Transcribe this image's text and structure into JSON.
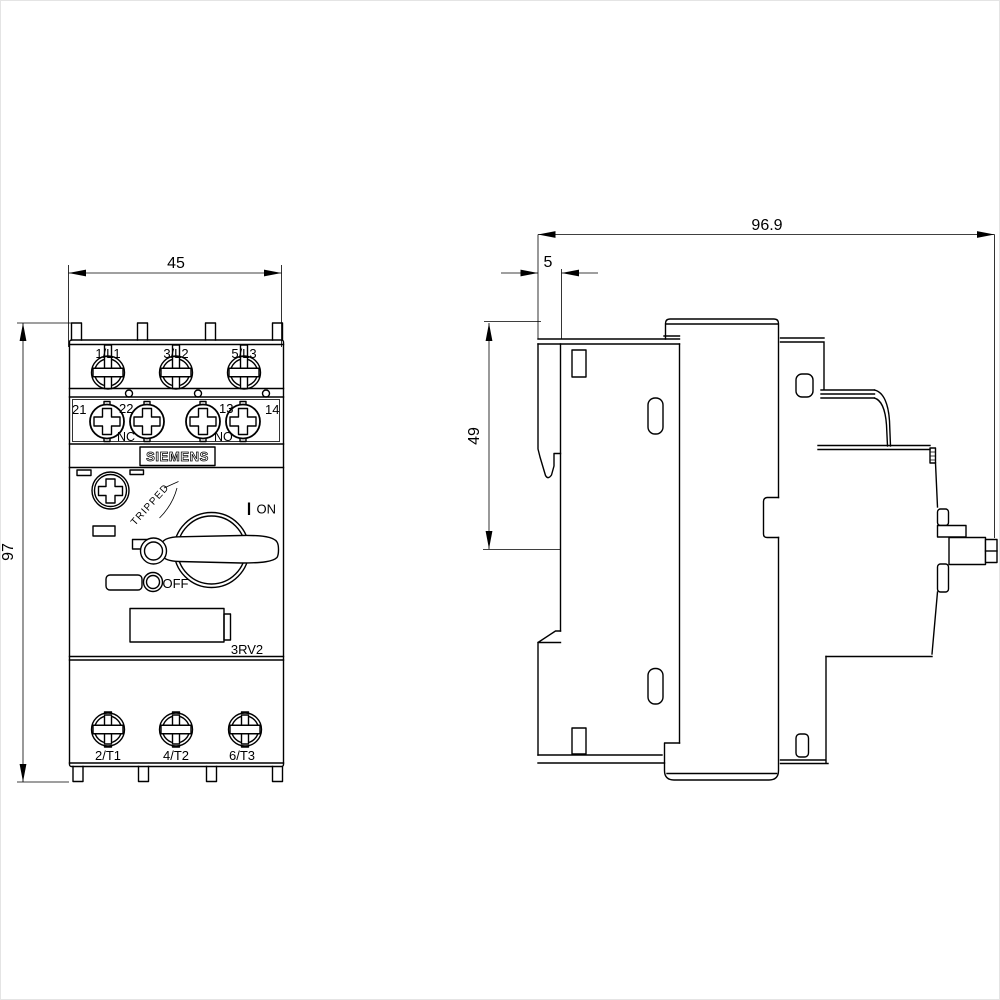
{
  "drawing": {
    "brand": "SIEMENS",
    "product_code": "3RV2",
    "colors": {
      "line": "#000000",
      "background": "#ffffff"
    },
    "front": {
      "dim_width": "45",
      "dim_height": "97",
      "top_terminals": [
        "1/L1",
        "3/L2",
        "5/L3"
      ],
      "aux_terminals": [
        "21",
        "22",
        "13",
        "14"
      ],
      "aux_contact_left": "NC",
      "aux_contact_right": "NO",
      "switch_on": "ON",
      "switch_off": "OFF",
      "switch_tripped": "TRIPPED",
      "bottom_terminals": [
        "2/T1",
        "4/T2",
        "6/T3"
      ]
    },
    "side": {
      "dim_depth_total": "96.9",
      "dim_clip_depth": "5",
      "dim_top_to_handle": "49"
    }
  }
}
